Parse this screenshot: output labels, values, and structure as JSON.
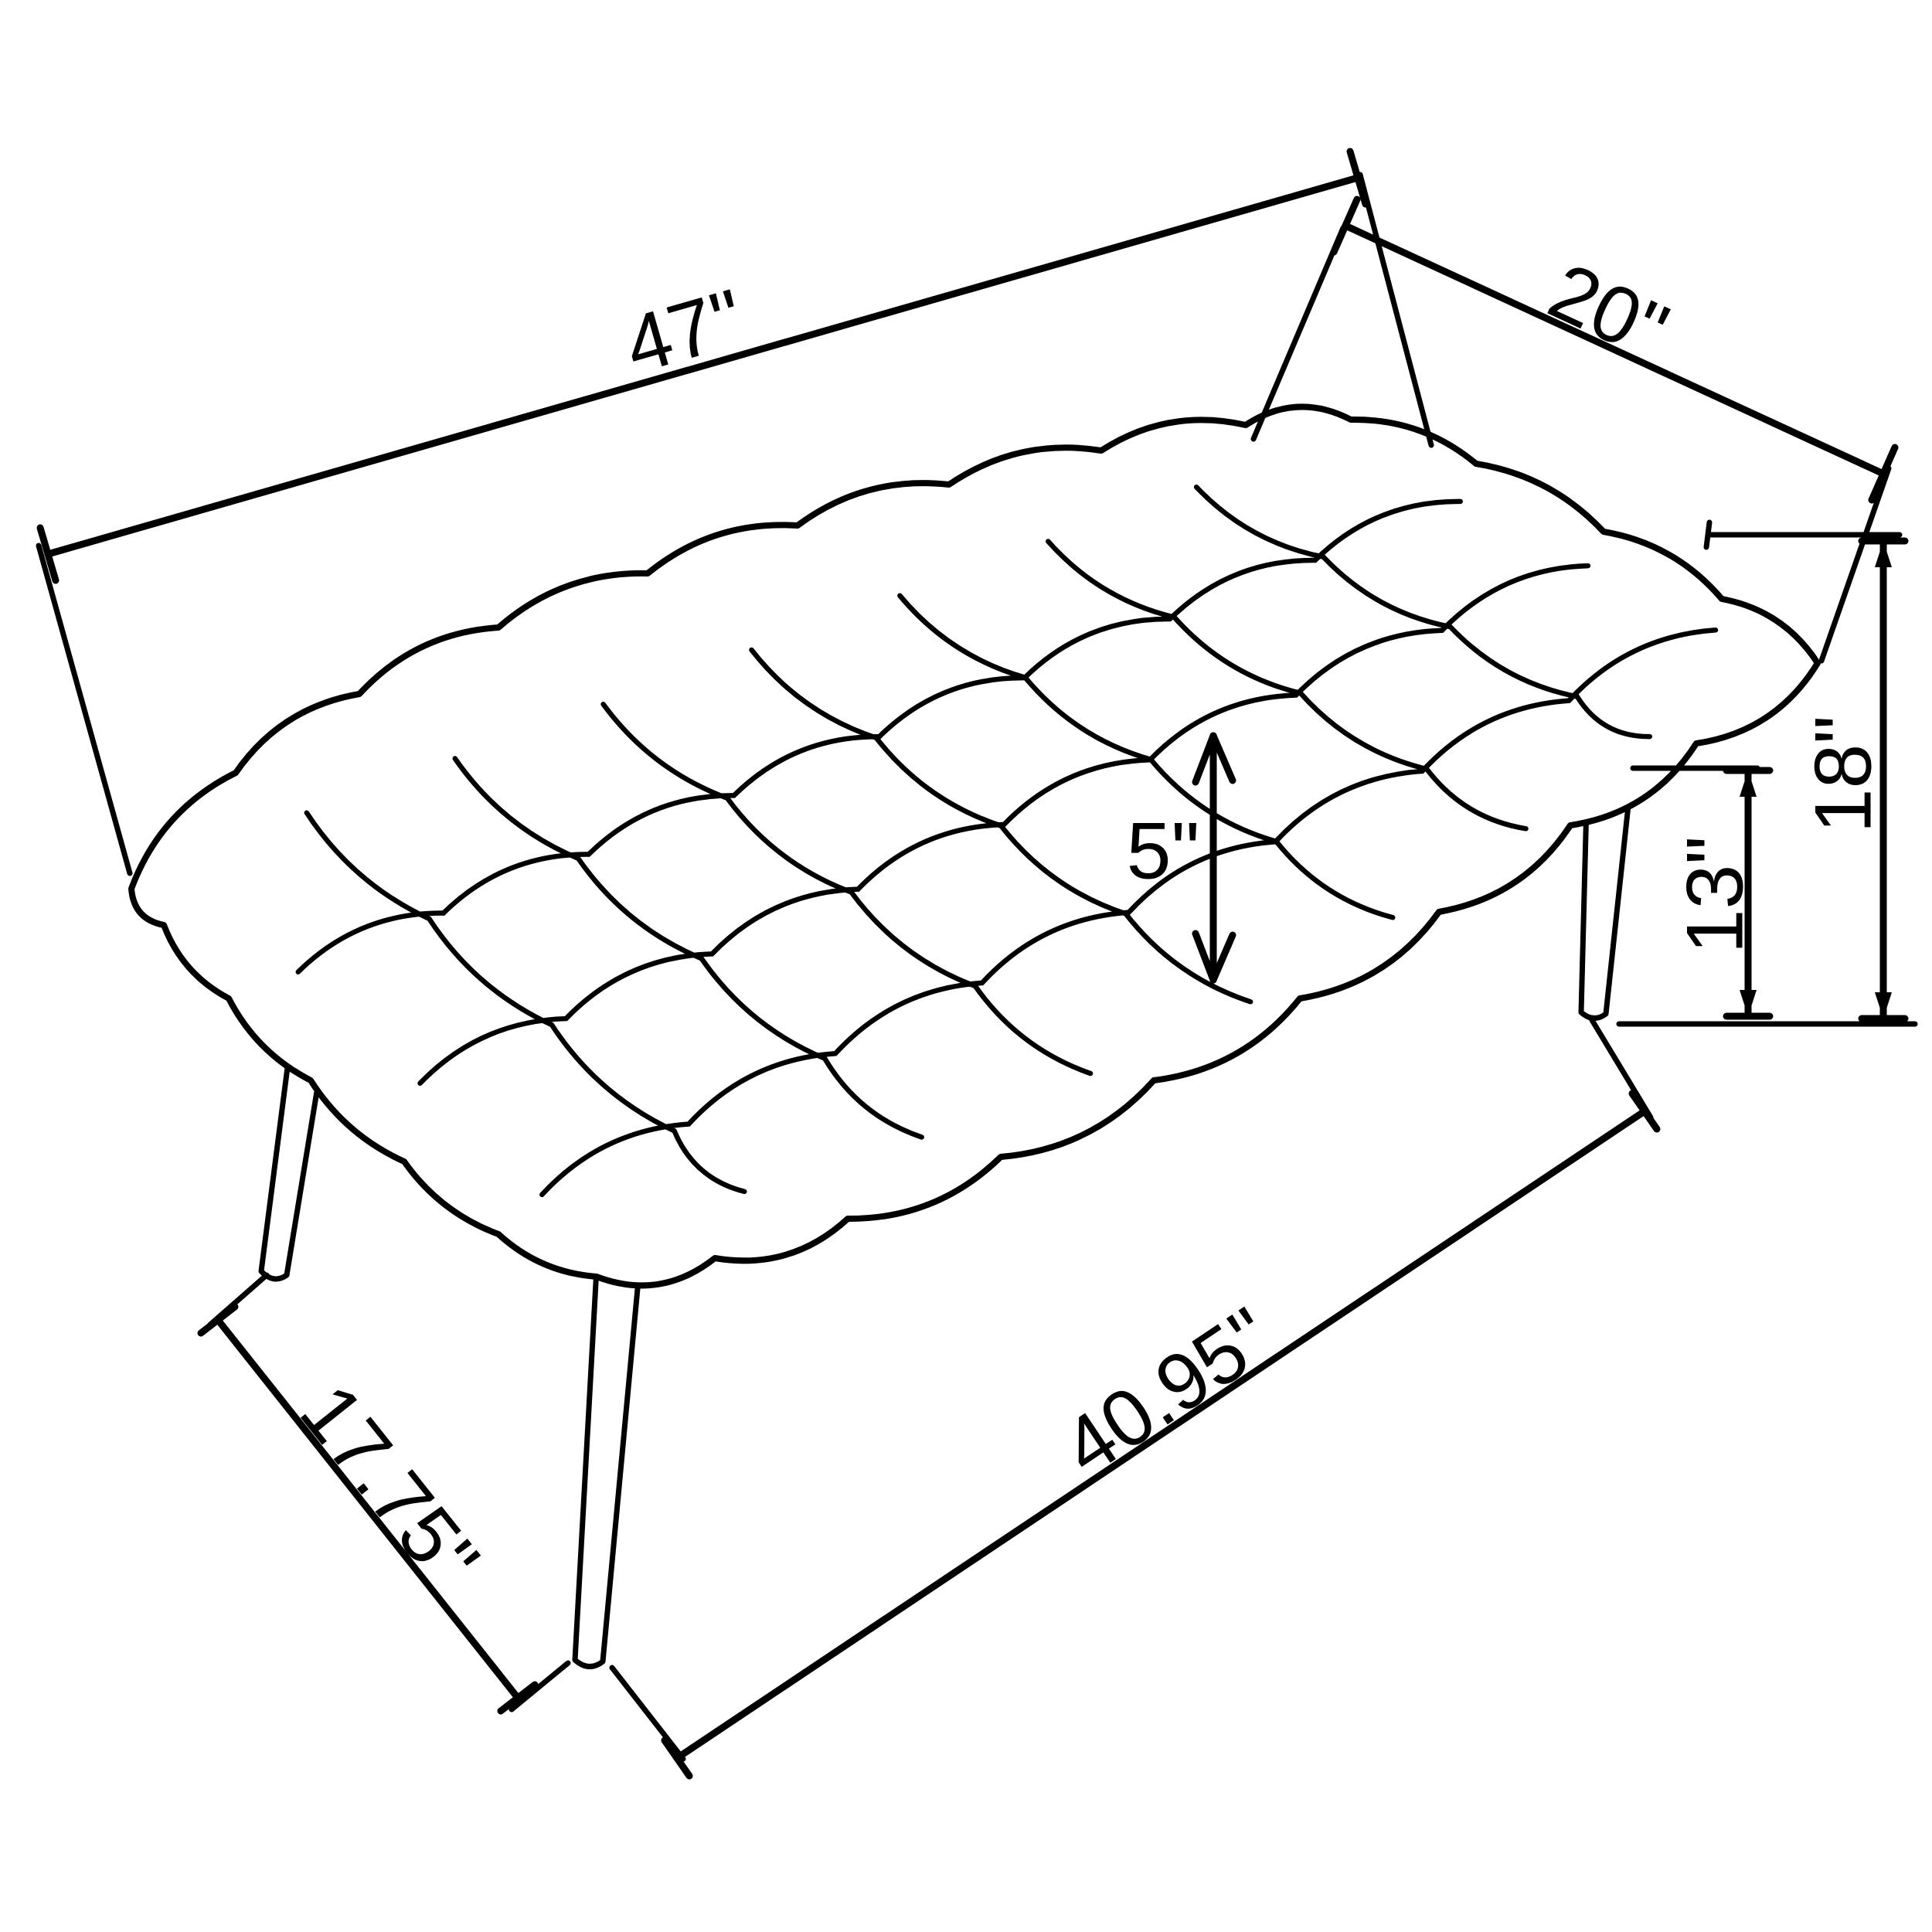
{
  "diagram": {
    "type": "furniture-dimension-drawing",
    "subject": "tufted bench with splayed tapered legs, isometric line drawing",
    "background_color": "#ffffff",
    "line_color": "#000000",
    "labels": {
      "seat_length": "47\"",
      "seat_depth": "20\"",
      "overall_height": "18\"",
      "leg_height": "13\"",
      "cushion_thickness": "5\"",
      "leg_span_depth": "17.75\"",
      "leg_span_length": "40.95\""
    }
  }
}
